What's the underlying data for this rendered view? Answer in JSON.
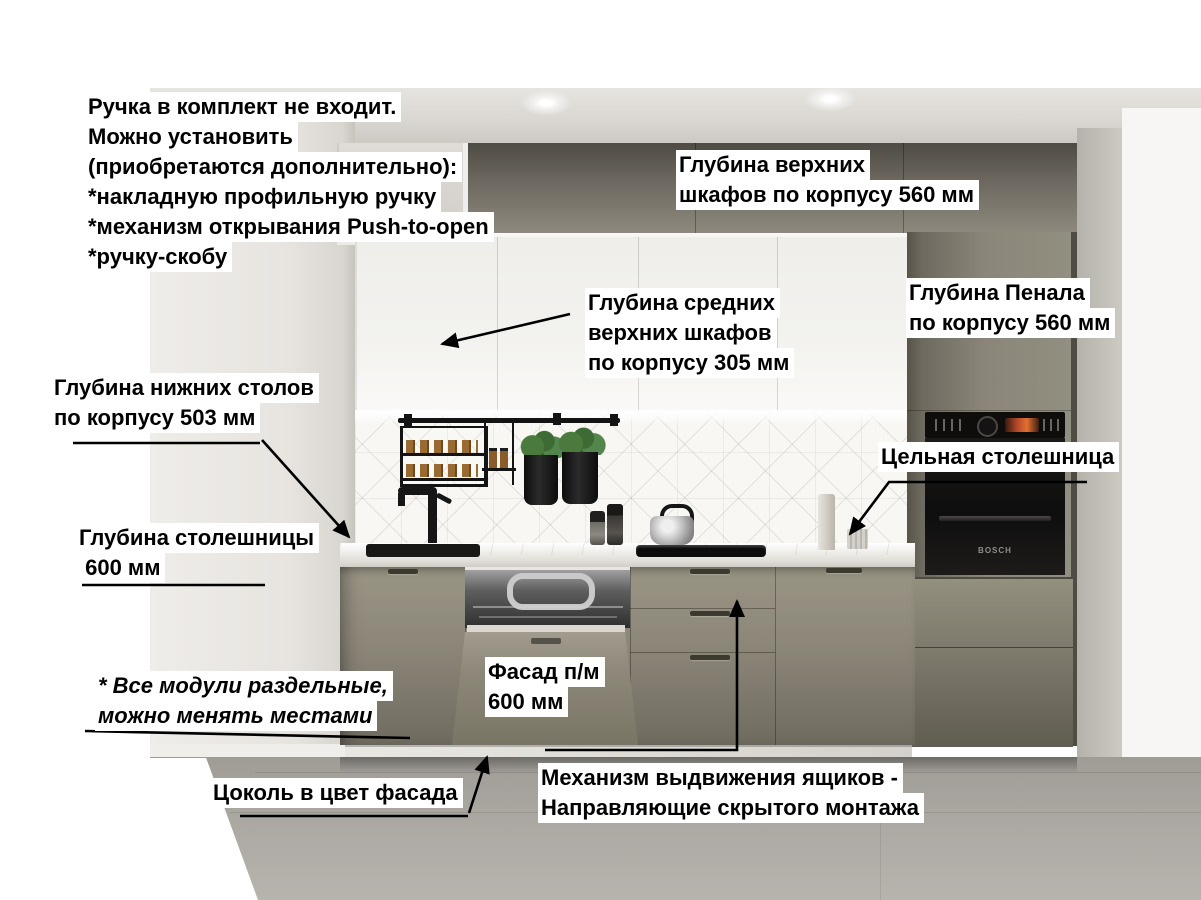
{
  "annotations": {
    "handle_note": {
      "lines": [
        "Ручка в комплект не входит.",
        "Можно установить",
        "(приобретаются дополнительно):",
        "*накладную профильную ручку",
        "*механизм открывания Push-to-open",
        "*ручку-скобу"
      ]
    },
    "upper_cabinets_depth": {
      "lines": [
        "Глубина верхних",
        "шкафов по корпусу 560 мм"
      ]
    },
    "middle_cabinets_depth": {
      "lines": [
        "Глубина средних",
        "верхних шкафов",
        "по корпусу 305 мм"
      ]
    },
    "tall_cabinet_depth": {
      "lines": [
        "Глубина Пенала",
        "по корпусу 560 мм"
      ]
    },
    "base_cabinets_depth": {
      "lines": [
        "Глубина нижних столов",
        "по корпусу 503 мм"
      ]
    },
    "solid_countertop": {
      "lines": [
        "Цельная столешница"
      ]
    },
    "countertop_depth": {
      "lines": [
        "Глубина столешницы",
        " 600 мм"
      ]
    },
    "modules_note": {
      "lines": [
        "* Все модули раздельные,",
        "можно менять местами"
      ]
    },
    "dishwasher_facade": {
      "lines": [
        "Фасад п/м",
        "600 мм"
      ]
    },
    "plinth_note": {
      "lines": [
        "Цоколь в цвет фасада"
      ]
    },
    "drawer_mechanism": {
      "lines": [
        "Механизм выдвижения ящиков -",
        "Направляющие скрытого монтажа"
      ]
    }
  },
  "scene": {
    "oven_brand": "BOSCH",
    "colors": {
      "label_bg": "#ffffff",
      "label_text": "#000000",
      "cabinet_taupe": "#8b8678",
      "top_cabinet_dark": "#5a564e",
      "white_cabinet": "#f2f1ee",
      "countertop_white": "#e9e7e2",
      "backsplash_white": "#f8f7f4",
      "oven_black": "#121010",
      "oven_display_orange": "#d96a2f",
      "floor_gray": "#a8a59f",
      "plant_green": "#46753a",
      "annotation_line": "#000000"
    }
  }
}
